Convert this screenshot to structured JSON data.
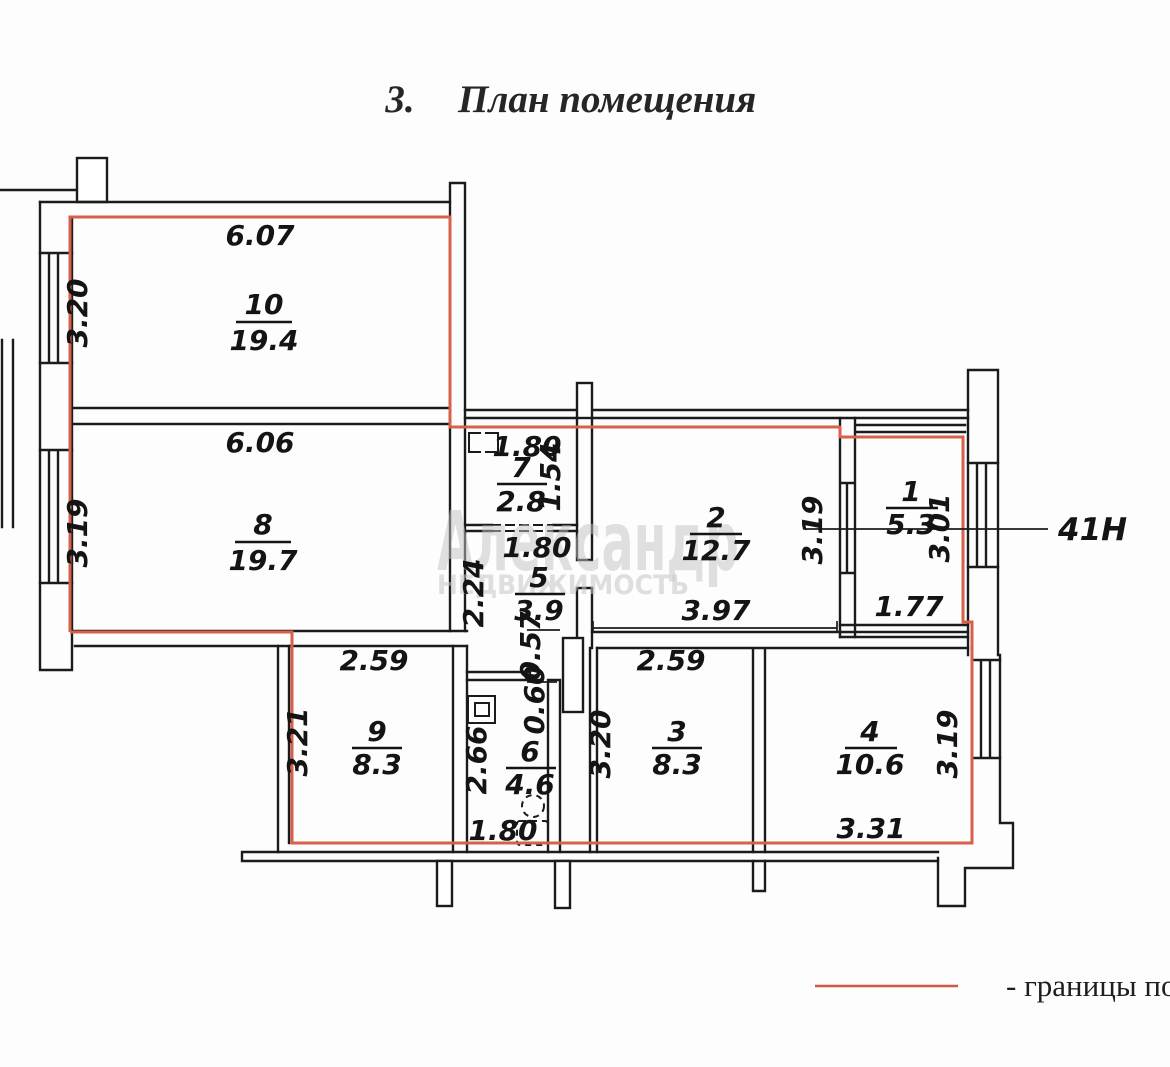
{
  "title": {
    "number": "3.",
    "text": "План помещения"
  },
  "watermark": {
    "line1": "Александр",
    "line2": "НЕДВИЖИМОСТЬ"
  },
  "unit_callout": "41Н",
  "legend": {
    "label": "- границы по"
  },
  "colors": {
    "boundary_red": "#d7604a",
    "wall_black": "#1b1b1b",
    "watermark_gray": "#c3c3c3"
  },
  "rooms": {
    "r10": {
      "number": "10",
      "area": "19.4",
      "width": "6.07",
      "height": "3.20"
    },
    "r8": {
      "number": "8",
      "area": "19.7",
      "width": "6.06",
      "height": "3.19"
    },
    "r7": {
      "number": "7",
      "area": "2.8",
      "width": "1.80",
      "height": "1.54"
    },
    "r5": {
      "number": "5",
      "area": "3.9",
      "width": "1.80",
      "height": "2.24"
    },
    "r2": {
      "number": "2",
      "area": "12.7",
      "width": "3.97",
      "height": "3.19"
    },
    "r1": {
      "number": "1",
      "area": "5.3",
      "width": "1.77",
      "height": "3.01"
    },
    "r9": {
      "number": "9",
      "area": "8.3",
      "width": "2.59",
      "height": "3.21"
    },
    "r6": {
      "number": "6",
      "area": "4.6",
      "width": "1.80",
      "height": "2.66"
    },
    "r3": {
      "number": "3",
      "area": "8.3",
      "width": "2.59",
      "height": "3.20"
    },
    "r4": {
      "number": "4",
      "area": "10.6",
      "width": "3.31",
      "height": "3.19"
    }
  },
  "passages": {
    "w057": "0.57",
    "w060": "0.60"
  }
}
